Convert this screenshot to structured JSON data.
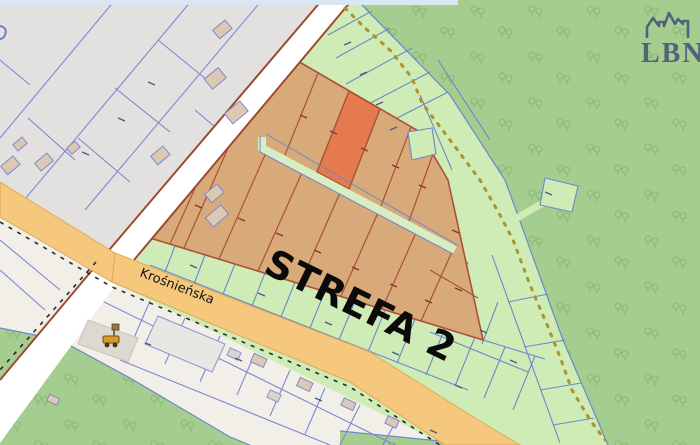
{
  "map": {
    "zone_label": "STREFA 2",
    "street_label": "Krośnieńska",
    "logo": {
      "text": "LBN",
      "icon": "castle-skyline-icon"
    },
    "poi": {
      "icon": "excavator-icon"
    },
    "highlighted_parcel": {
      "status": "selected",
      "color": "#e57a4e"
    },
    "palette": {
      "forest_green": "#a6cd90",
      "tree_glyph": "#8cba74",
      "parcel_green": "#cfecb6",
      "parcel_green_border": "#6d87cc",
      "urban_gray": "#e3e1e0",
      "land_cream": "#f2efe9",
      "zone_tan": "#d9aa79",
      "zone_border_red": "#ab5038",
      "highlight_orange": "#e57a4e",
      "road_orange": "#f5c87e",
      "road_orange_casing": "#dfa955",
      "road_white": "#ffffff",
      "road_brown_edge": "#9c4a2f",
      "trail_yellow": "#ab9430",
      "boundary_dash_black": "#2b2b2b",
      "top_strip_blue": "#d8e7f3",
      "logo_blue": "#51627b",
      "building_tan": "#dcc9b2",
      "building_gray": "#dad5cc"
    }
  }
}
